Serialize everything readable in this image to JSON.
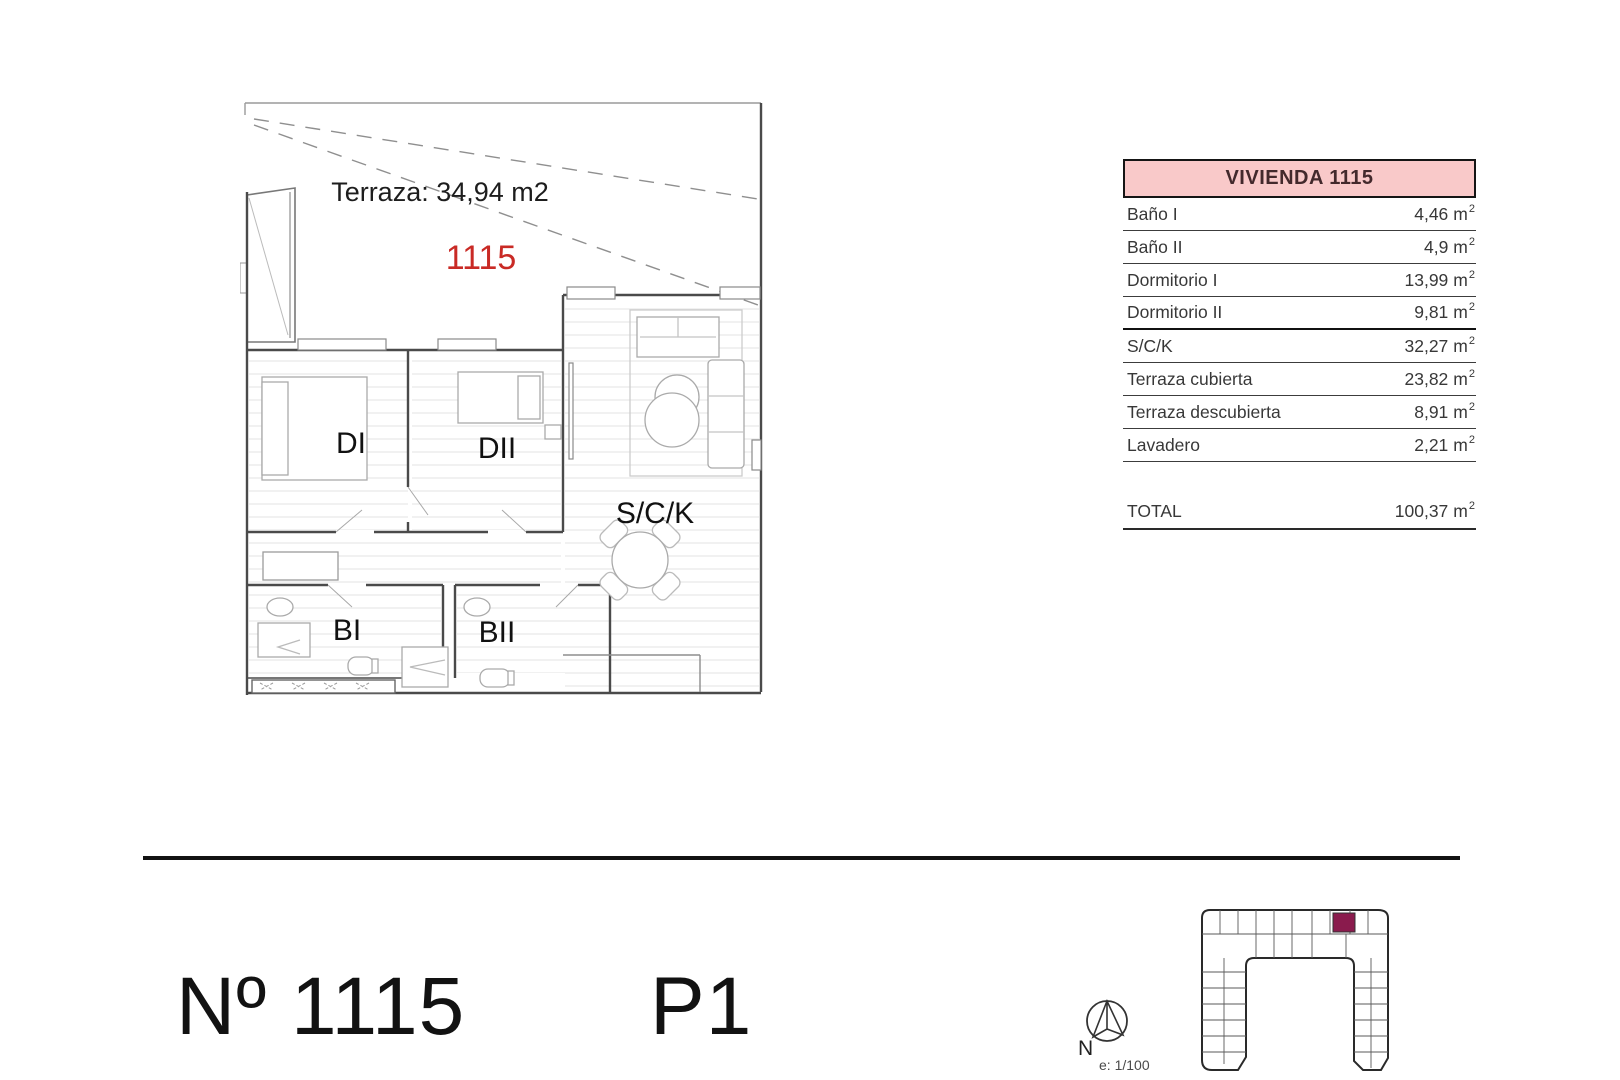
{
  "floor_plan": {
    "terrace_label": "Terraza: 34,94 m2",
    "unit_number": "1115",
    "room_labels": {
      "di": "DI",
      "dii": "DII",
      "sck": "S/C/K",
      "bi": "BI",
      "bii": "BII"
    }
  },
  "area_table": {
    "title": "VIVIENDA 1115",
    "rows": [
      {
        "label": "Baño I",
        "value": "4,46",
        "unit": "m",
        "unit_sup": "2"
      },
      {
        "label": "Baño II",
        "value": "4,9",
        "unit": "m",
        "unit_sup": "2"
      },
      {
        "label": "Dormitorio I",
        "value": "13,99",
        "unit": "m",
        "unit_sup": "2"
      },
      {
        "label": "Dormitorio II",
        "value": "9,81",
        "unit": "m",
        "unit_sup": "2"
      },
      {
        "label": "S/C/K",
        "value": "32,27",
        "unit": "m",
        "unit_sup": "2"
      },
      {
        "label": "Terraza cubierta",
        "value": "23,82",
        "unit": "m",
        "unit_sup": "2"
      },
      {
        "label": "Terraza descubierta",
        "value": "8,91",
        "unit": "m",
        "unit_sup": "2"
      },
      {
        "label": "Lavadero",
        "value": "2,21",
        "unit": "m",
        "unit_sup": "2"
      }
    ],
    "total": {
      "label": "TOTAL",
      "value": "100,37",
      "unit": "m",
      "unit_sup": "2"
    }
  },
  "footer": {
    "unit_title": "Nº 1115",
    "floor_label": "P1",
    "compass_north": "N",
    "scale_label": "e: 1/100"
  },
  "colors": {
    "header_pink": "#f9c9c9",
    "unit_red": "#c92a25",
    "site_highlight": "#8a1b4d",
    "divider_black": "#121212"
  }
}
